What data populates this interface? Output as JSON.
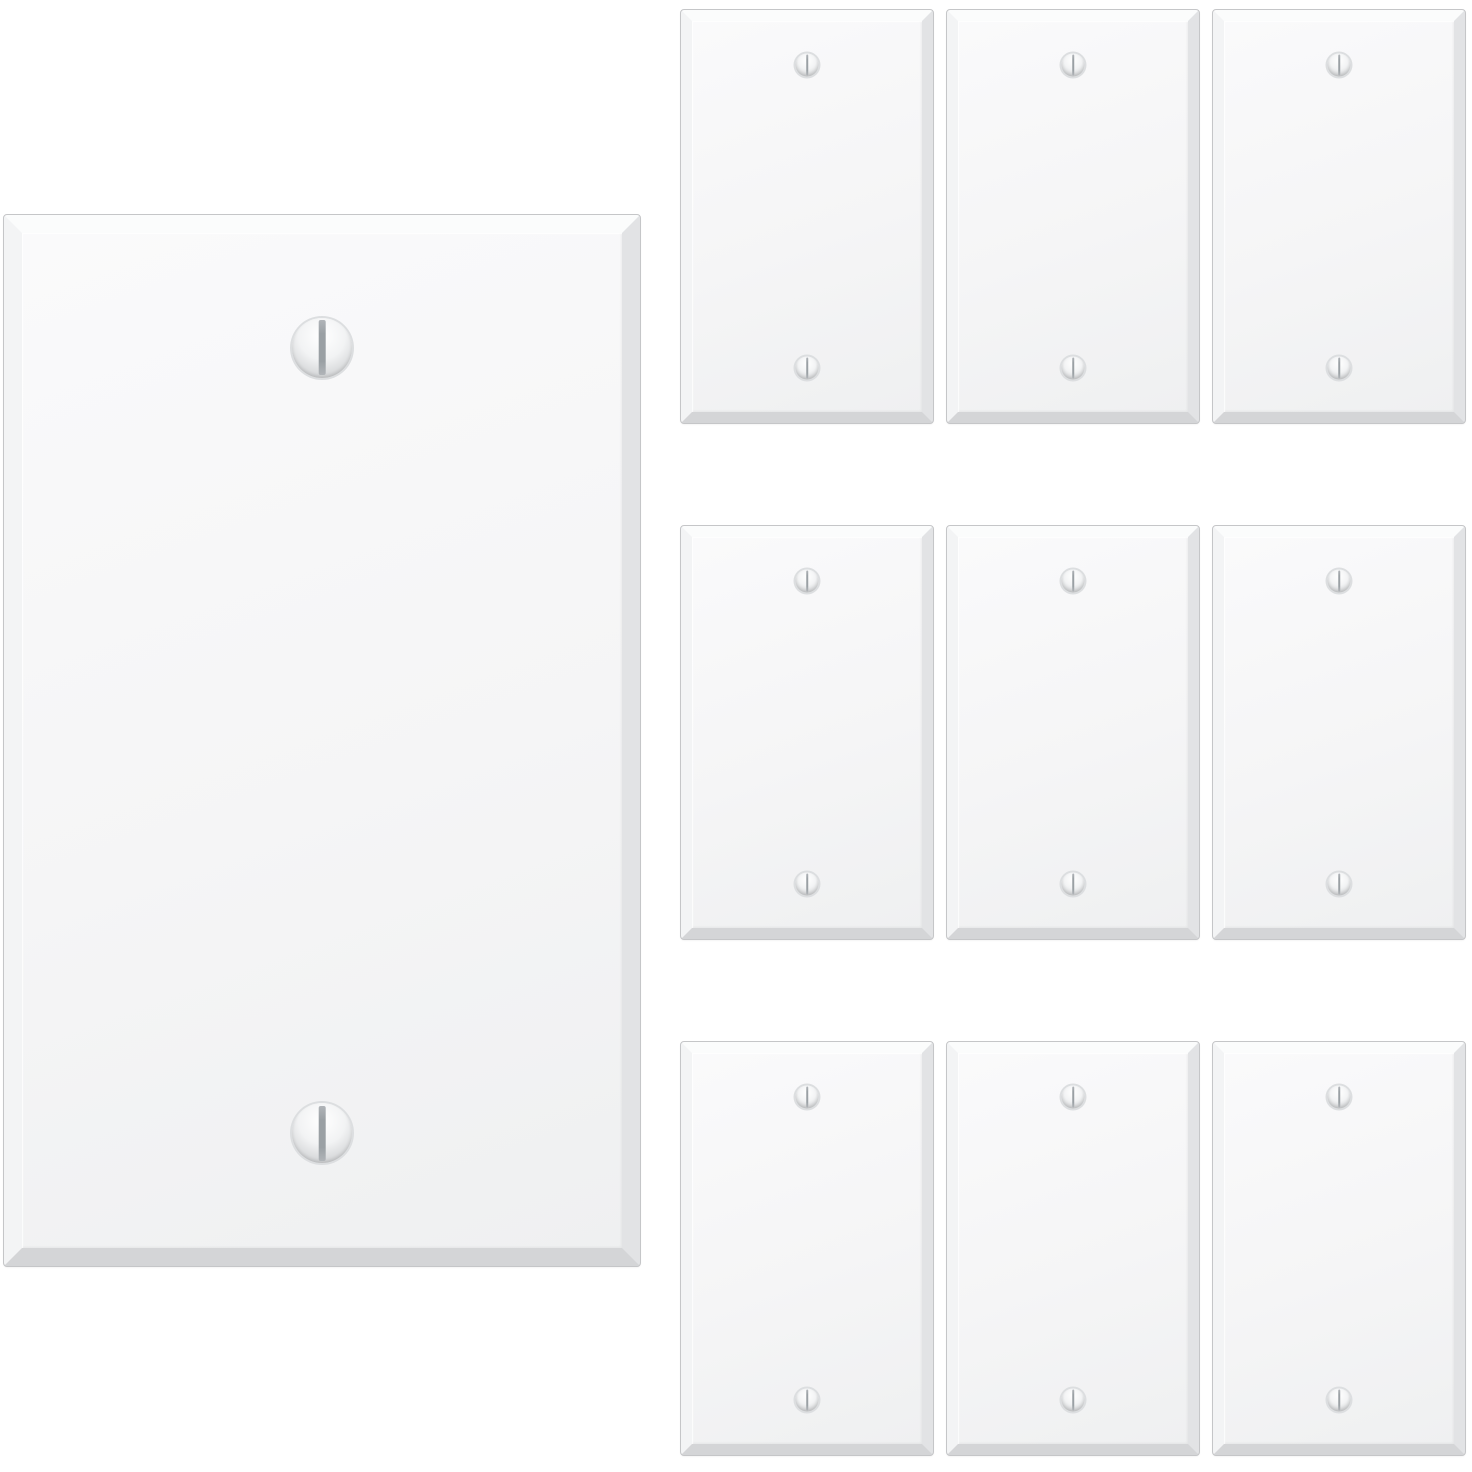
{
  "image": {
    "description": "Product photo of blank white one-gang wall plates: one enlarged plate on the left and a grid of nine identical smaller plates on the right, each with a beveled edge and two vertical-slot screws"
  },
  "large_plate": {
    "screw_count": 2
  },
  "grid": {
    "rows": 3,
    "cols": 3,
    "count": 9,
    "screws_per_plate": 2
  },
  "colors": {
    "background": "#ffffff",
    "plate_face_light": "#fafafb",
    "plate_face": "#f5f5f6",
    "plate_face_dark": "#eff0f1",
    "bevel_top": "#fbfcfc",
    "bevel_left": "#f3f4f5",
    "bevel_right": "#e2e3e5",
    "bevel_bottom": "#d4d5d7",
    "edge_line": "#c5c6c8",
    "screw_highlight": "#ffffff",
    "screw_body": "#f2f3f4",
    "screw_shadow": "#c6c8ca",
    "screw_ring": "#dcdee0",
    "screw_slot": "#9aa0a4"
  }
}
